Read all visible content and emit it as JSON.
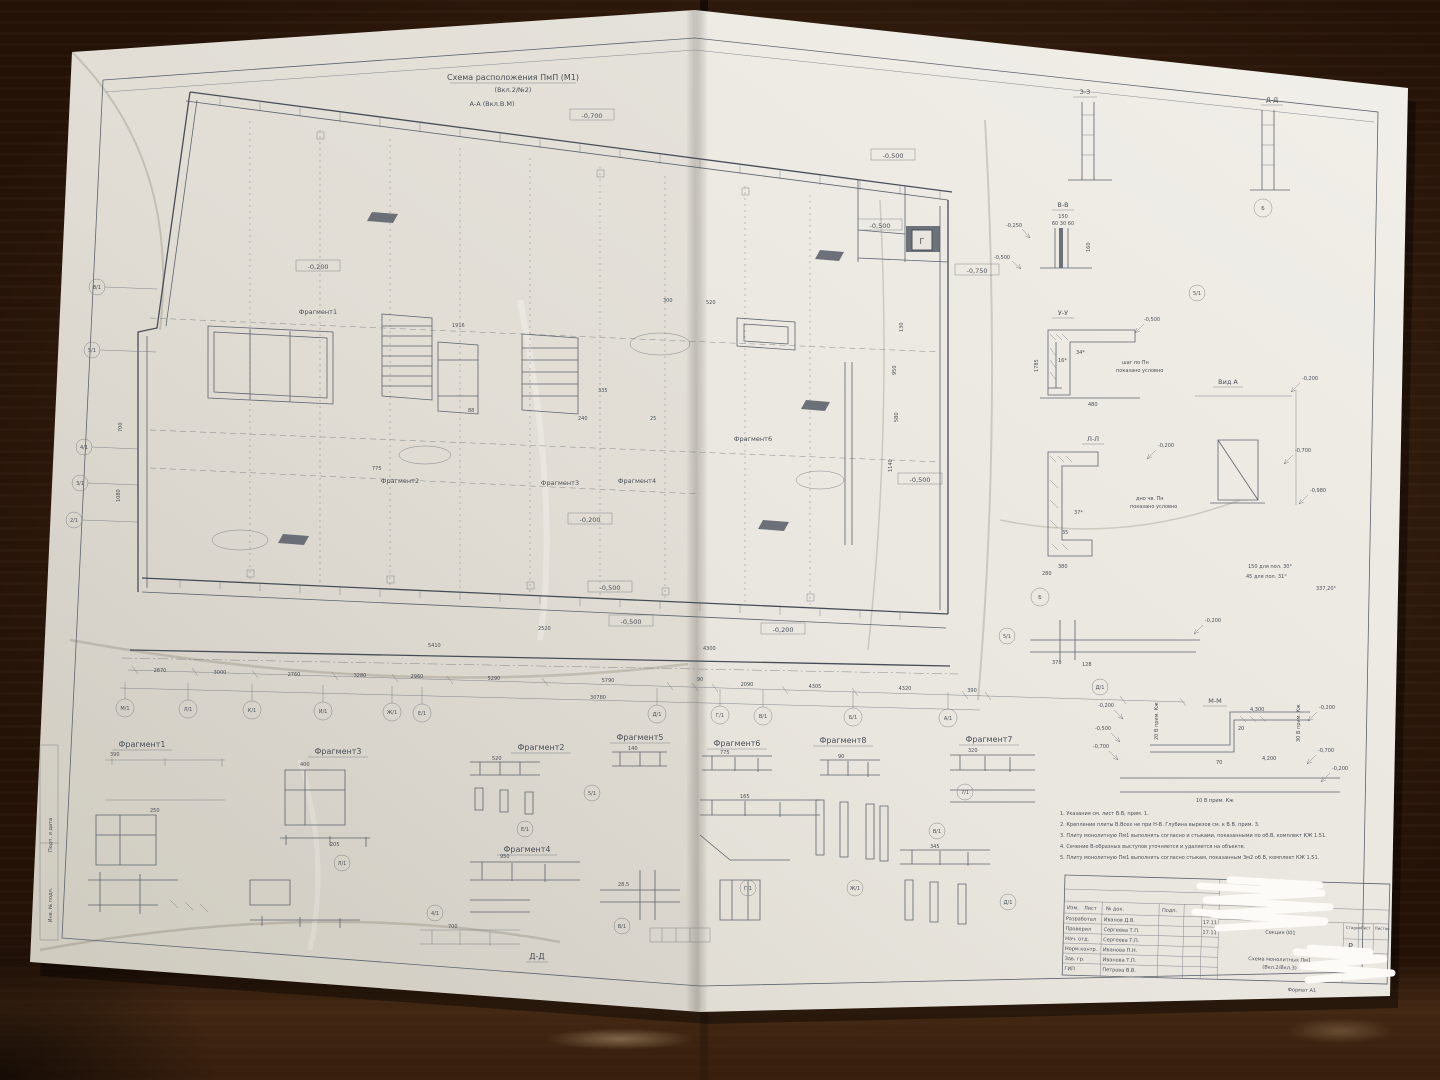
{
  "colors": {
    "paper": "#e9e6df",
    "paper_bright": "#f1efe9",
    "paper_shadow": "#d6d2c7",
    "ink": "#4a5058",
    "wood_dark": "#2c190c",
    "wood_light": "#7a4e2c",
    "redaction": "#fcfbf7"
  },
  "top": {
    "title": "Схема расположения ПмП (М1)",
    "subtitle": "(Вкл.2/№2)",
    "section_note": "А-А (Вкл.В.М)"
  },
  "axes": {
    "bottom": [
      "М/1",
      "Л/1",
      "К/1",
      "И/1",
      "Ж/1",
      "Е/1",
      "Д/1",
      "Г/1",
      "В/1",
      "Б/1",
      "А/1"
    ],
    "left": [
      "8/1",
      "5/1",
      "4/1",
      "3/1",
      "2/1"
    ],
    "scatter": [
      "Б",
      "5/1",
      "Б",
      "5/1",
      "Д/1",
      "5/1",
      "7/1",
      "В/1",
      "Ж/1",
      "Д/1",
      "Г/1",
      "В/1",
      "Л/1",
      "Е/1",
      "4/1"
    ]
  },
  "elevations": [
    "-0,700",
    "-0,500",
    "-0,200",
    "-0,500",
    "-0,750",
    "-0,500",
    "-0,200",
    "-0,500",
    "-0,500",
    "-0,200",
    "-0,250",
    "-0,500",
    "-0,500",
    "-0,200",
    "-0,200",
    "-0,700",
    "-0,980",
    "-0,200",
    "-0,200",
    "-0,500",
    "-0,700",
    "-0,200",
    "-0,700",
    "-0,200"
  ],
  "sections": {
    "titles": [
      "З-З",
      "Д-Д",
      "В-В",
      "У-У",
      "Вид А",
      "Л-Л",
      "М-М",
      "Д-Д"
    ],
    "detail_letter": "Г"
  },
  "fragments": {
    "row": [
      "Фрагмент1",
      "Фрагмент3",
      "Фрагмент2",
      "Фрагмент5",
      "Фрагмент6",
      "Фрагмент8",
      "Фрагмент7"
    ],
    "below": "Фрагмент4",
    "inplan": [
      "Фрагмент1",
      "Фрагмент2",
      "Фрагмент3",
      "Фрагмент4",
      "Фрагмент6"
    ]
  },
  "dims": {
    "chain": [
      "2870",
      "3000",
      "2760",
      "3280",
      "2960",
      "5290",
      "5790",
      "90",
      "2090",
      "4305",
      "4320",
      "390"
    ],
    "total": "30780",
    "small": [
      "150",
      "60 30 60",
      "160",
      "1916",
      "775",
      "300",
      "520",
      "130",
      "950",
      "580",
      "1140",
      "700",
      "1080",
      "2520",
      "5410",
      "4300",
      "240",
      "88",
      "335",
      "25",
      "1785",
      "380",
      "280",
      "37*",
      "35",
      "34*",
      "16*",
      "480",
      "378",
      "128",
      "4,300",
      "4,200",
      "20",
      "70"
    ],
    "frag": [
      "390",
      "250",
      "400",
      "205",
      "520",
      "950",
      "140",
      "775",
      "90",
      "320",
      "165",
      "345",
      "700",
      "28,5"
    ]
  },
  "micro": [
    "шаг по Пн",
    "показано условно",
    "дно чв. Пн",
    "показано условно",
    "150 для пол. 30°",
    "45 для пол. 31°",
    "337,20°",
    "20 В прим. Кж",
    "30 В прим. Кж",
    "10 В прим. Кж"
  ],
  "notes": [
    "1.  Указания см. лист В.В, прим. 1.",
    "2.  Крепление плиты В.Всех не при Н-В. Глубина вырезов см. к В.В, прим. 3.",
    "3.  Плиту монолитную Пм1 выполнять согласно и стыками, показанными по об.В, комплект КЖ 1.51.",
    "4.  Сечение В-образных выступов уточняется и удаляется на объекте.",
    "5.  Плиту монолитную Пм1 выполнять согласно стыкам, показанным 3м2 об.В, комплект КЖ 1.51."
  ],
  "stamp": {
    "header": [
      "Изм.",
      "Лист",
      "№ док.",
      "Подп.",
      "Дата"
    ],
    "rows": [
      [
        "Разработал",
        "Иванов Д.В.",
        "17.11"
      ],
      [
        "Проверил",
        "Сергеева Т.П.",
        "17.11"
      ],
      [
        "Нач. отд.",
        "Сергеева Т.П.",
        ""
      ],
      [
        "Норм.контр.",
        "Иванова П.Н.",
        ""
      ],
      [
        "Зав. гр.",
        "Иванова Т.П.",
        ""
      ],
      [
        "ГИП",
        "Петрова В.В.",
        ""
      ]
    ],
    "object": "Секция 001",
    "sheet_title_1": "Схема монолитных Пм1",
    "sheet_title_2": "(Вкл.2/Вкл.3)",
    "stage_cols": [
      "Стадия",
      "Лист",
      "Листов"
    ],
    "stage": "Р",
    "format": "Формат А1"
  },
  "edge_labels": [
    "Подп. и дата",
    "Инв. № подл."
  ]
}
